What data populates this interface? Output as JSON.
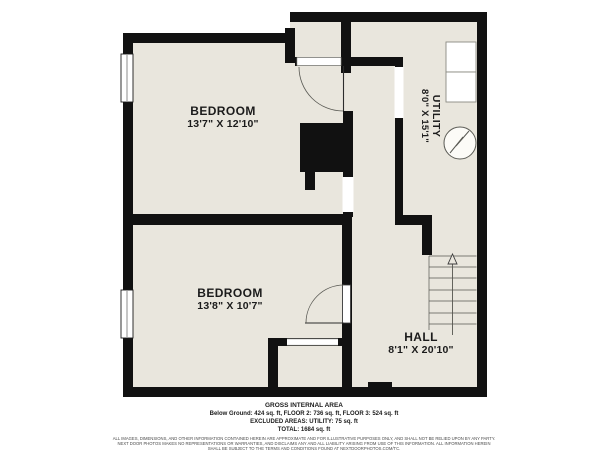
{
  "floor_plan": {
    "rooms": [
      {
        "id": "bedroom-1",
        "name": "BEDROOM",
        "dimensions": "13'7\" X 12'10\""
      },
      {
        "id": "bedroom-2",
        "name": "BEDROOM",
        "dimensions": "13'8\" X 10'7\""
      },
      {
        "id": "utility",
        "name": "UTILITY",
        "dimensions": "8'0\" X 15'1\""
      },
      {
        "id": "hall",
        "name": "HALL",
        "dimensions": "8'1\" X 20'10\""
      }
    ],
    "symbols": [
      "window",
      "door-swing",
      "staircase",
      "up-arrow",
      "water-heater",
      "appliance",
      "chimney"
    ],
    "colors": {
      "floor": "#e9e6dd",
      "wall": "#111111",
      "background": "#ffffff",
      "opening": "#ffffff"
    },
    "footer": {
      "title": "GROSS INTERNAL AREA",
      "areas_line": "Below Ground: 424 sq. ft, FLOOR 2: 736 sq. ft, FLOOR 3: 524 sq. ft",
      "excluded_line": "EXCLUDED AREAS: UTILITY: 75 sq. ft",
      "total_line": "TOTAL: 1684 sq. ft",
      "disclaimer_line1": "ALL IMAGES, DIMENSIONS, AND OTHER INFORMATION CONTAINED HEREIN ARE APPROXIMATE AND FOR ILLUSTRATIVE PURPOSES ONLY, AND SHALL NOT BE RELIED UPON BY ANY PARTY.",
      "disclaimer_line2": "NEXT DOOR PHOTOS MAKES NO REPRESENTATIONS OR WARRANTIES, AND DISCLAIMS ANY AND ALL LIABILITY ARISING FROM USE OF THIS INFORMATION. ALL INFORMATION HEREIN",
      "disclaimer_line3": "SHALL BE SUBJECT TO THE TERMS AND CONDITIONS FOUND AT NEXTDOORPHOTOS.COM/TC."
    }
  }
}
